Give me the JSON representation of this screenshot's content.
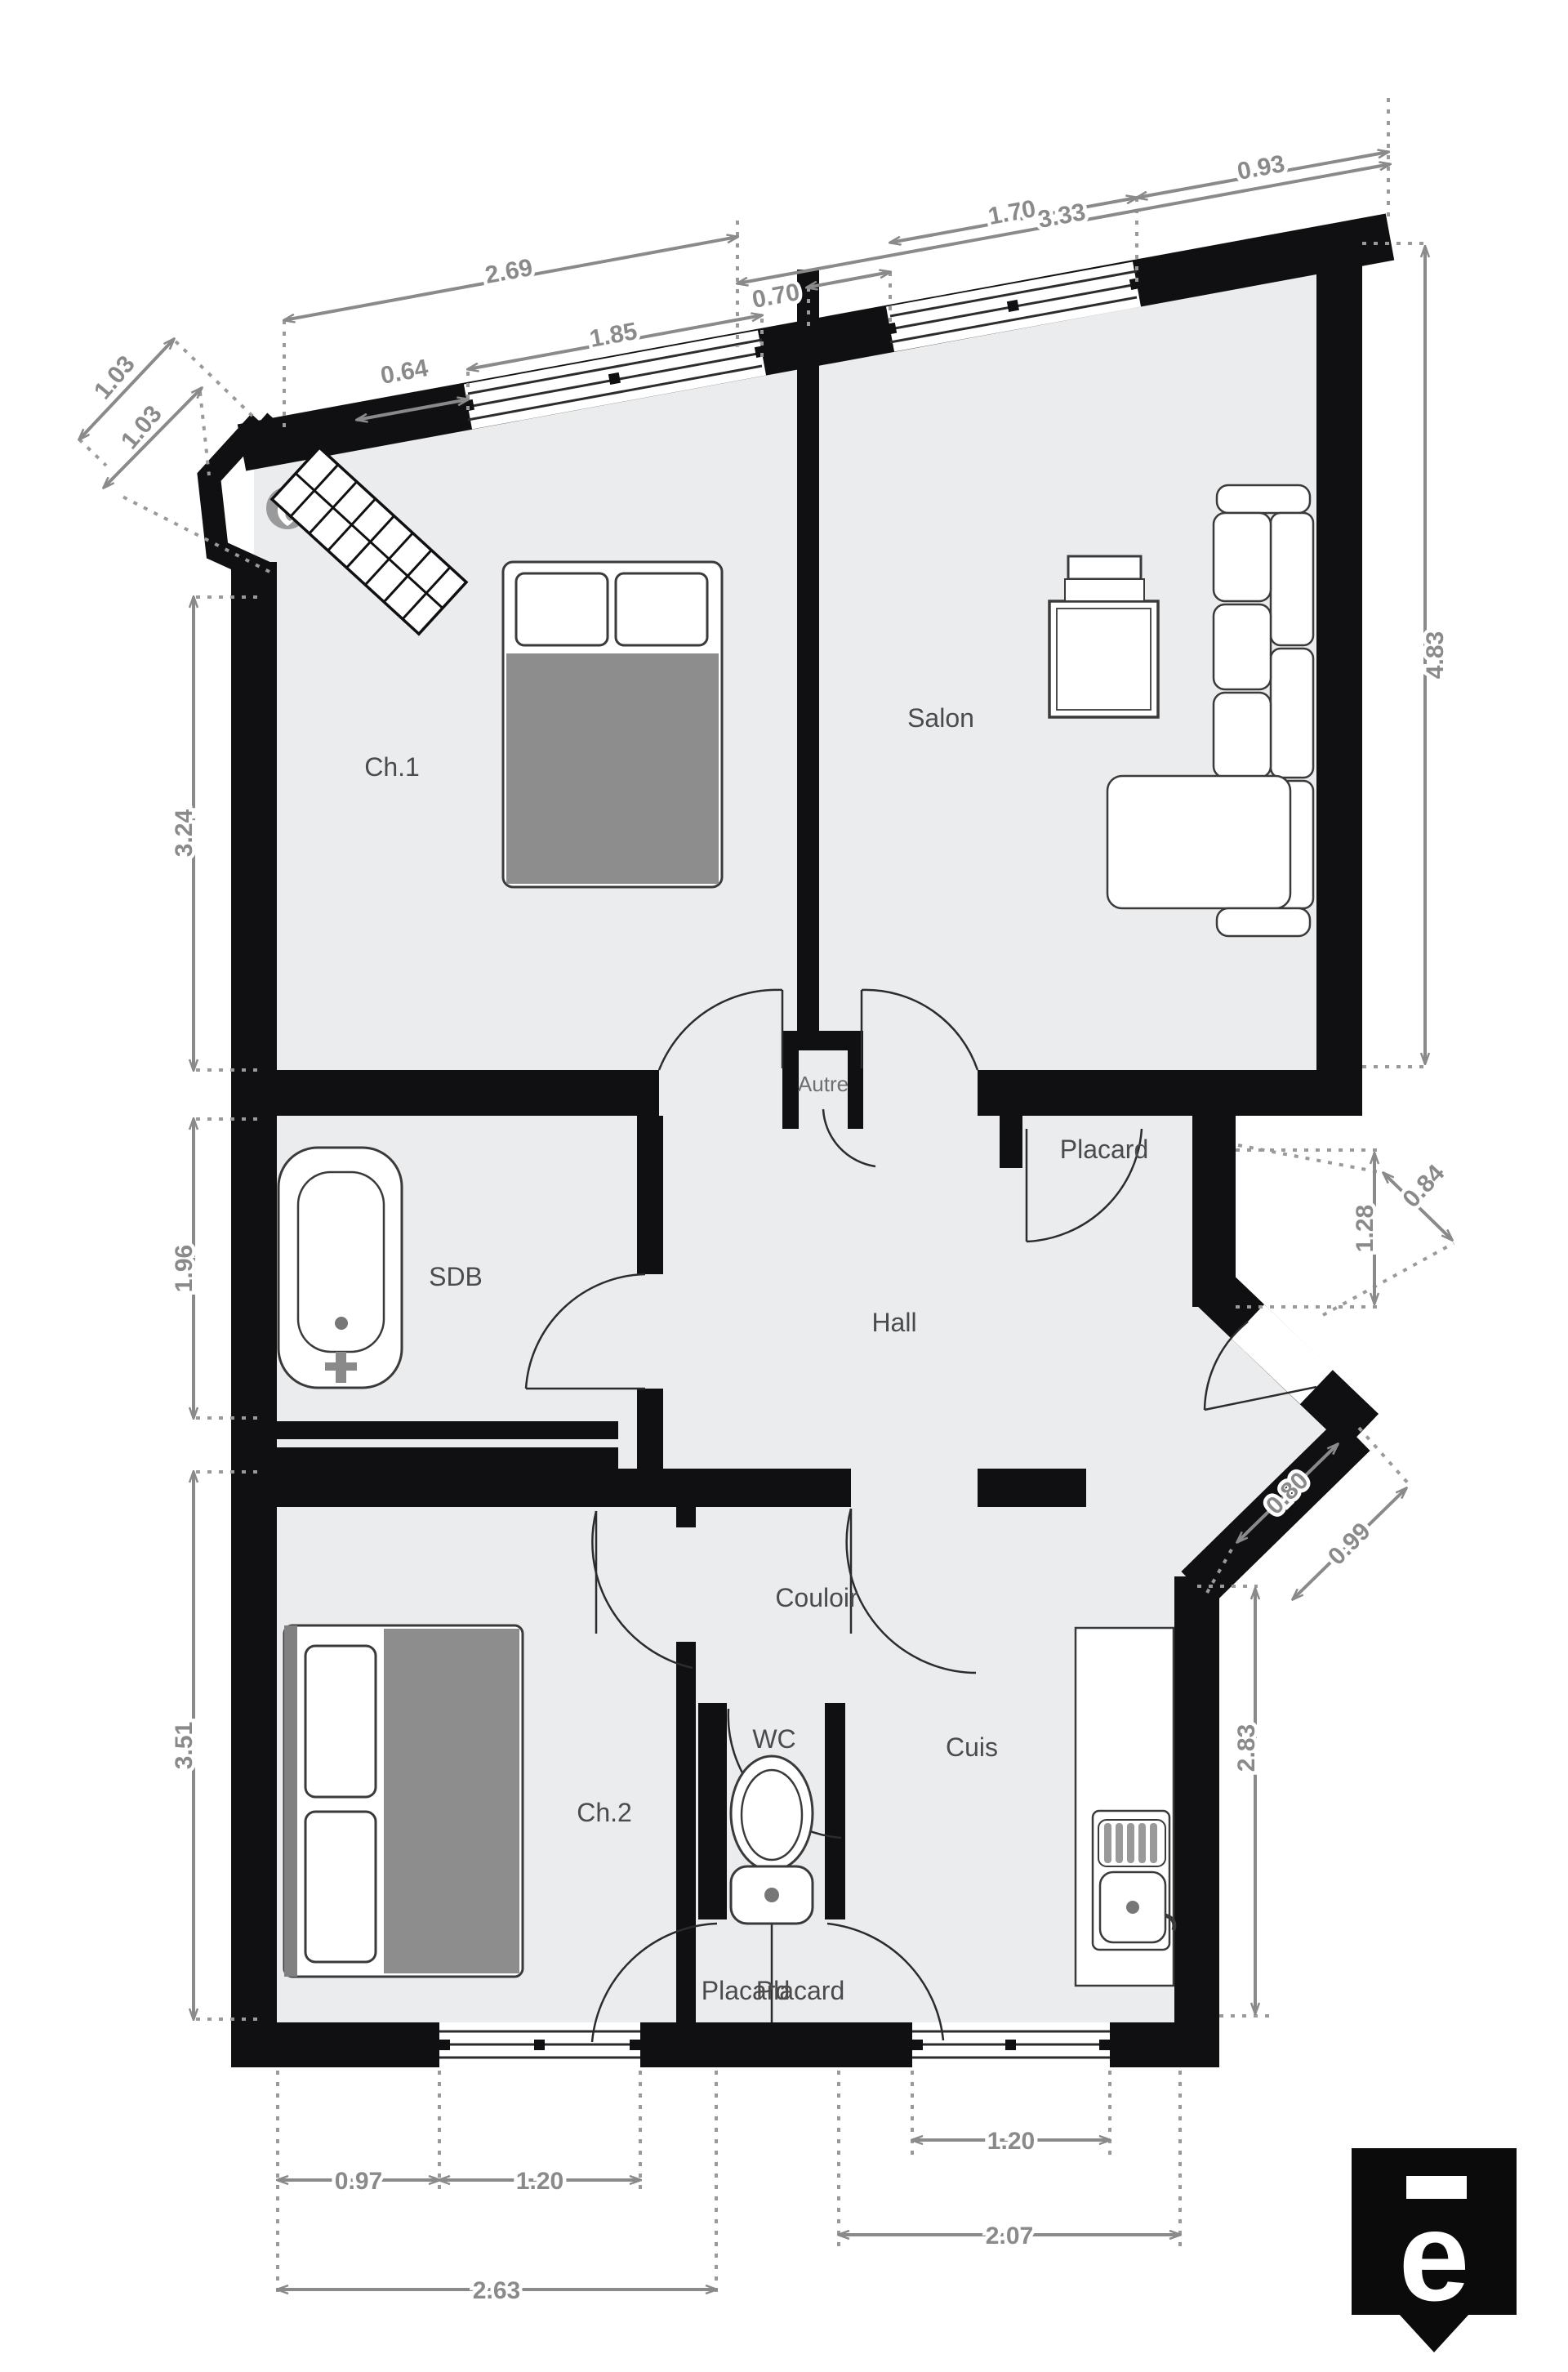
{
  "plan_type": "floor-plan",
  "colors": {
    "wall": "#101012",
    "floor": "#ebecee",
    "dim": "#8a8a8a",
    "label": "#4b4b4b",
    "furniture_fill": "#ffffff",
    "furniture_line": "#3a3a3a",
    "duvet_gray": "#8d8d8d",
    "logo_bg": "#0b0b0b"
  },
  "rooms": {
    "ch1": "Ch.1",
    "salon": "Salon",
    "sdb": "SDB",
    "hall": "Hall",
    "autre": "Autre",
    "placard": "Placard",
    "couloir": "Couloir",
    "wc": "WC",
    "cuis": "Cuis",
    "ch2": "Ch.2",
    "placard_b1": "Placard",
    "placard_b2": "Placard"
  },
  "dims": {
    "d333": "3.33",
    "d093": "0.93",
    "d170": "1.70",
    "d070": "0.70",
    "d269": "2.69",
    "d185": "1.85",
    "d064": "0.64",
    "d103a": "1.03",
    "d103b": "1.03",
    "d324": "3.24",
    "d196": "1.96",
    "d351": "3.51",
    "d483": "4.83",
    "d128": "1.28",
    "d084": "0.84",
    "d080": "0.80",
    "d099": "0.99",
    "d283": "2.83",
    "d097": "0.97",
    "d120a": "1.20",
    "d263": "2.63",
    "d120b": "1.20",
    "d207": "2.07"
  },
  "logo": {
    "letter": "e"
  }
}
